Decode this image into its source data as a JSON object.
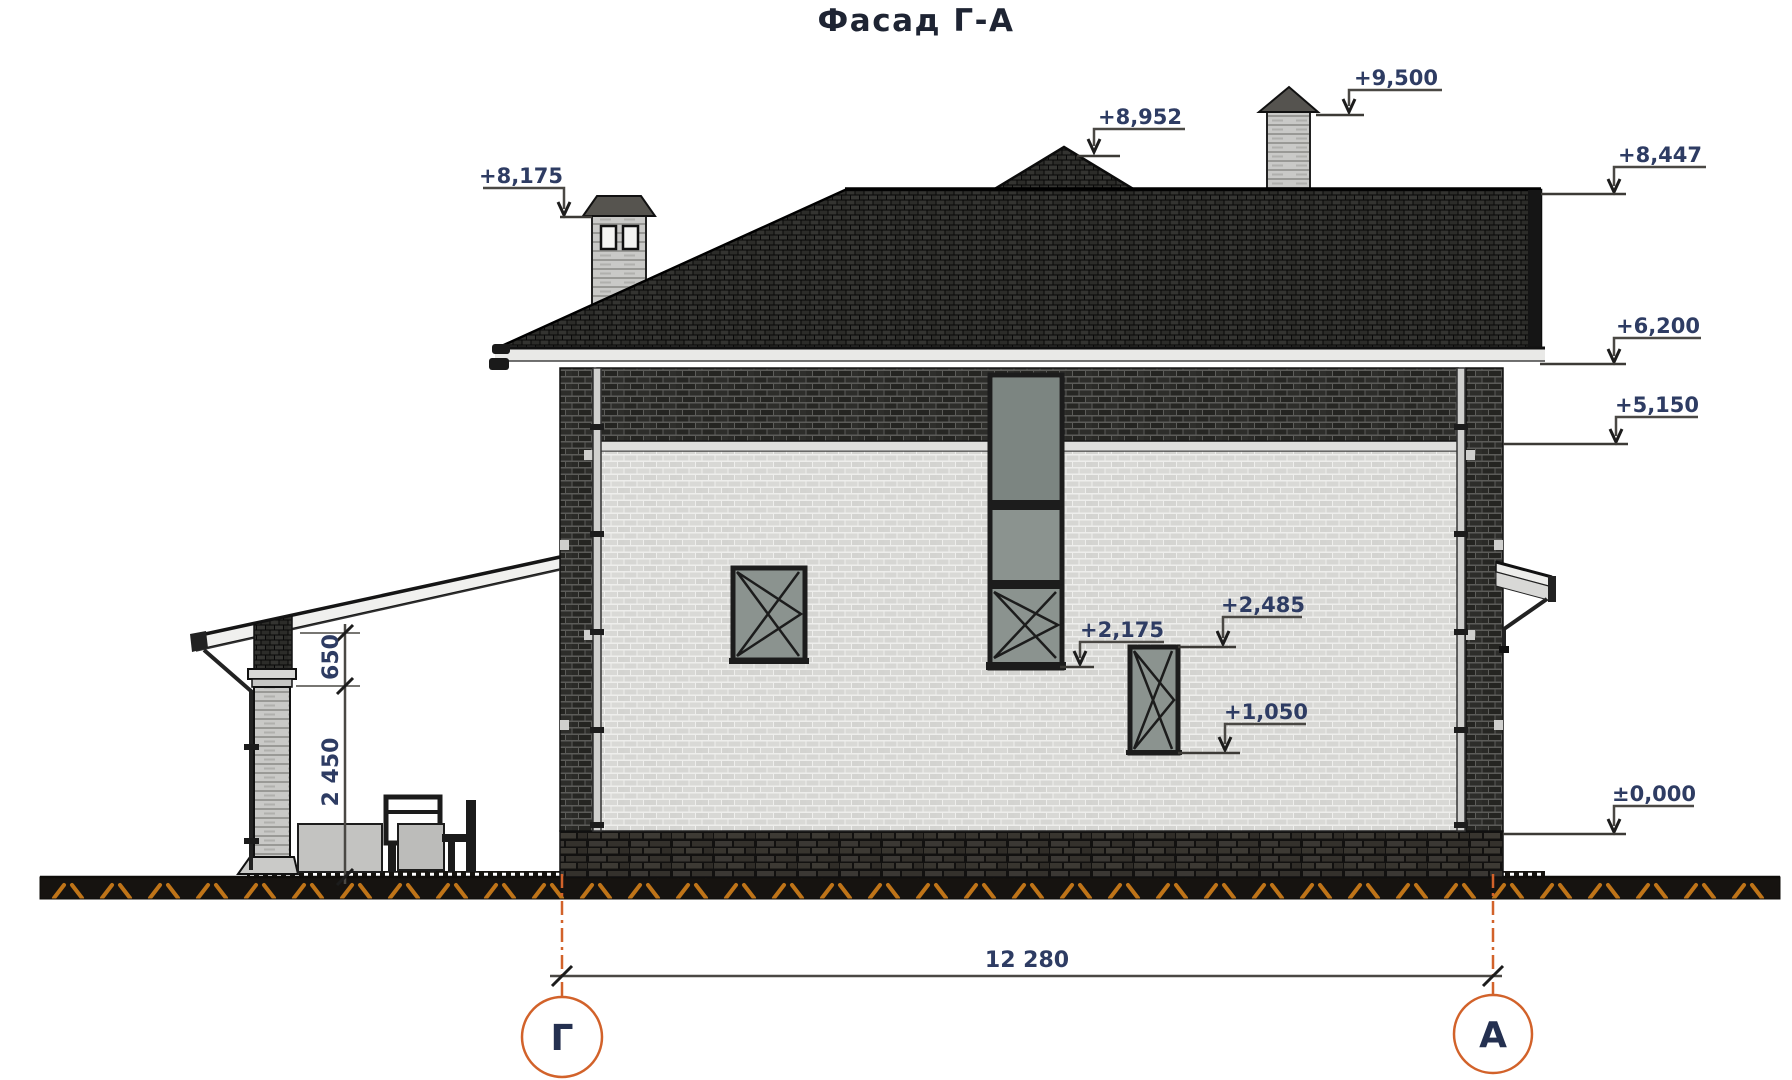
{
  "title": "Фасад Г-А",
  "colors": {
    "accent_orange": "#d2622a",
    "annotation_navy": "#2e3c63",
    "ground_hatch_orange": "#bf7418",
    "roof_dark": "#1a1a1a",
    "wall_light": "#d6d6d3",
    "band_dark": "#2d2d2a"
  },
  "elevation_marks": [
    {
      "label": "+8,175"
    },
    {
      "label": "+8,952"
    },
    {
      "label": "+9,500"
    },
    {
      "label": "+8,447"
    },
    {
      "label": "+6,200"
    },
    {
      "label": "+5,150"
    },
    {
      "label": "+2,485"
    },
    {
      "label": "+2,175"
    },
    {
      "label": "+1,050"
    },
    {
      "label": "±0,000"
    }
  ],
  "dimensions": {
    "porch_upper": "650",
    "porch_lower": "2 450",
    "overall_width": "12 280"
  },
  "axes": {
    "left": "Г",
    "right": "А"
  }
}
